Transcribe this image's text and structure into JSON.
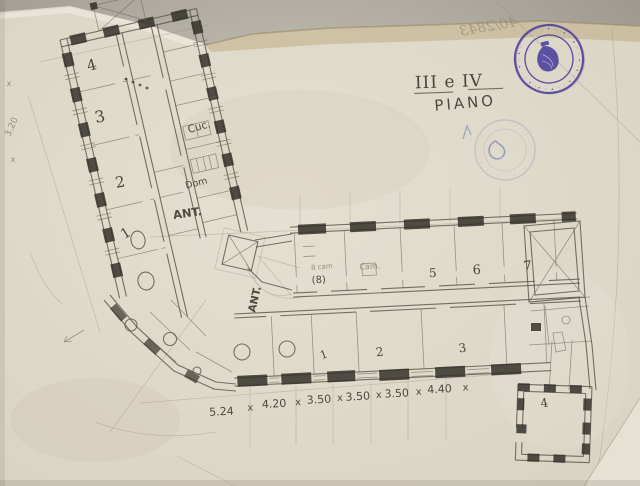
{
  "titles": {
    "floor": "III e IV",
    "floor_word": "PIANO"
  },
  "annotations": {
    "archive_number_mirrored": "40/2843",
    "left_dimension": "3.20",
    "dim_mark": "x"
  },
  "stamp": {
    "color": "#4b3e9f",
    "ring_glyphs": "· • · ·• · • · · • ·• · • · · • · •· • · · • · • ·"
  },
  "plan": {
    "rooms": {
      "left_wing": [
        "4",
        "3",
        "2",
        "1"
      ],
      "top_row": [
        "5",
        "6",
        "7"
      ],
      "bottom_row": [
        "1",
        "2",
        "3"
      ],
      "small_wing": "4",
      "room8": "(8)"
    },
    "labels": {
      "kitchen": "Cuc.",
      "dom": "Dom",
      "ant1": "ANT.",
      "ant2": "ANT.",
      "room8_note": "8 cam",
      "cam": "Cam."
    },
    "dimensions": {
      "values": [
        "5.24",
        "4.20",
        "3.50",
        "3.50",
        "3.50",
        "4.40"
      ],
      "separator": "x"
    }
  }
}
